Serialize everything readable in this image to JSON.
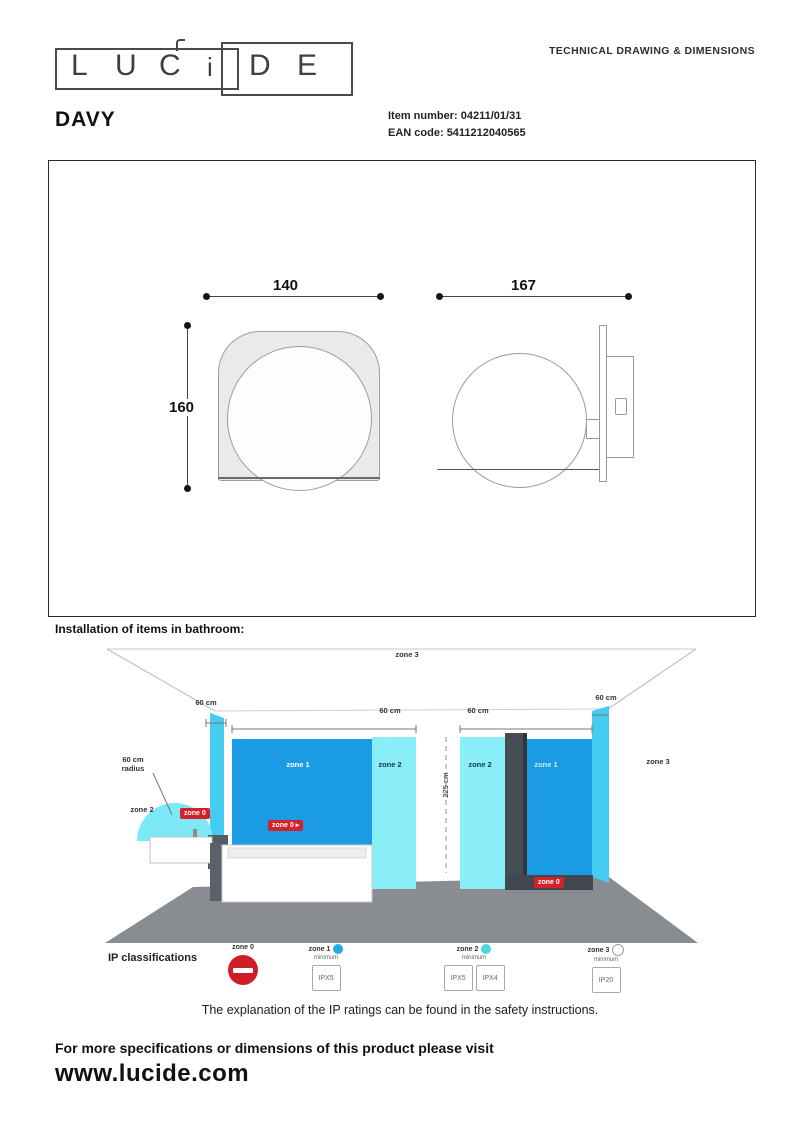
{
  "header": {
    "logo_letters": [
      "L",
      "U",
      "C",
      "i",
      "D",
      "E"
    ],
    "doc_type": "TECHNICAL DRAWING & DIMENSIONS",
    "product_name": "DAVY",
    "item_number_label": "Item number:",
    "item_number": "04211/01/31",
    "ean_label": "EAN code:",
    "ean": "5411212040565"
  },
  "drawing": {
    "front_width": "140",
    "front_height": "160",
    "side_width": "167"
  },
  "bathroom": {
    "title": "Installation of items in bathroom:",
    "ceiling_zone": "zone 3",
    "dim_left": "60 cm",
    "dim_mid_left": "60 cm",
    "dim_mid_right": "60 cm",
    "dim_right": "60 cm",
    "radius_label": "60 cm radius",
    "basin_zone": "zone 2",
    "height_dim": "225 cm",
    "panel_zone1_left": "zone 1",
    "panel_zone2_left": "zone 2",
    "panel_zone2_right": "zone 2",
    "panel_zone1_right": "zone 1",
    "wall_zone3_right": "zone 3",
    "badge_basin": "zone 0",
    "badge_bath": "zone 0",
    "badge_shower": "zone 0",
    "badge_arrow": "▸"
  },
  "ip": {
    "heading": "IP classifications",
    "zones": [
      {
        "label": "zone 0",
        "sub": "",
        "ratings": []
      },
      {
        "label": "zone 1",
        "sub": "minimum",
        "ratings": [
          "IPX5"
        ]
      },
      {
        "label": "zone 2",
        "sub": "minimum",
        "ratings": [
          "IPX5",
          "IPX4"
        ]
      },
      {
        "label": "zone 3",
        "sub": "minimum",
        "ratings": [
          "IP20"
        ]
      }
    ],
    "note": "The explanation of the IP ratings can be found in the safety instructions."
  },
  "footer": {
    "line1": "For more specifications or dimensions of this product please visit",
    "url": "www.lucide.com"
  },
  "colors": {
    "blue_panel": "#1a9be3",
    "cyan_panel": "#8aeef8",
    "edge_strip": "#44ccf1",
    "floor": "#898d92",
    "badge_red": "#d3222a",
    "zone1_dot": "#29abe2",
    "zone2_dot": "#4fd6e0"
  }
}
